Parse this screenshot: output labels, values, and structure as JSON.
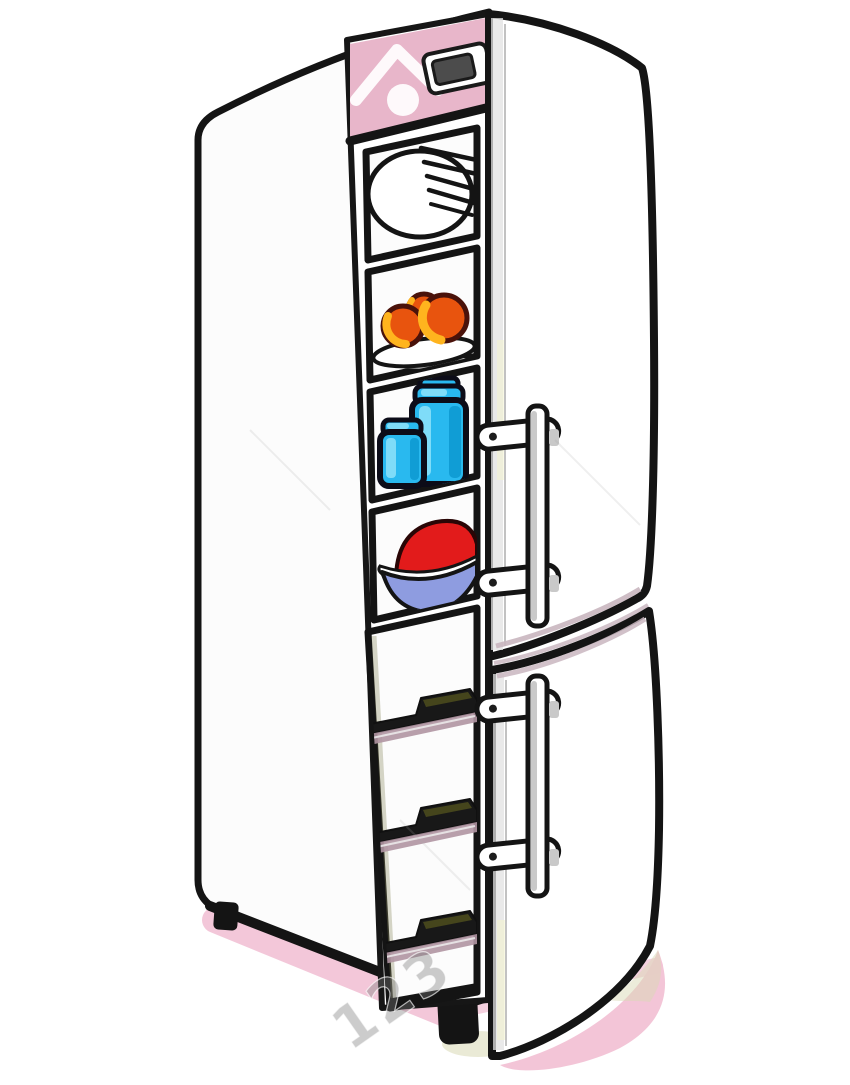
{
  "scene": {
    "description": "Cartoon refrigerator-freezer with both doors open",
    "watermark_text": "123RF",
    "watermark_partial": "123"
  },
  "items": {
    "shelf_1": "stack-of-plates",
    "shelf_2": "plate-with-peaches",
    "shelf_3": "two-blue-jars",
    "shelf_4": "bowl-with-red-fruit",
    "freezer": "freezer-drawers",
    "display": "temperature-display"
  },
  "colors": {
    "outline": "#141414",
    "body_white": "#ffffff",
    "interior_pink": "#e8b6ca",
    "display_screen": "#4c4c4c",
    "fruit_orange": "#e8540e",
    "fruit_yellow": "#ffb41e",
    "fruit_outline": "#4a120a",
    "jar_blue": "#29b9ef",
    "jar_light": "#7fdcf8",
    "jar_dark": "#0d9ad2",
    "bowl_blue": "#8e9ce0",
    "berry_red": "#e21b1b",
    "tab_olive": "#45451c",
    "band_mauve": "#b095a2",
    "shadow_pink": "#f2c2d5",
    "shadow_olive": "#d9d9b5",
    "handle_gray": "#c9c9c9",
    "edge_gray": "#e2e2e2",
    "edge_yellow": "#f4f4cf",
    "plate_shadow": "#cfcfcf"
  }
}
